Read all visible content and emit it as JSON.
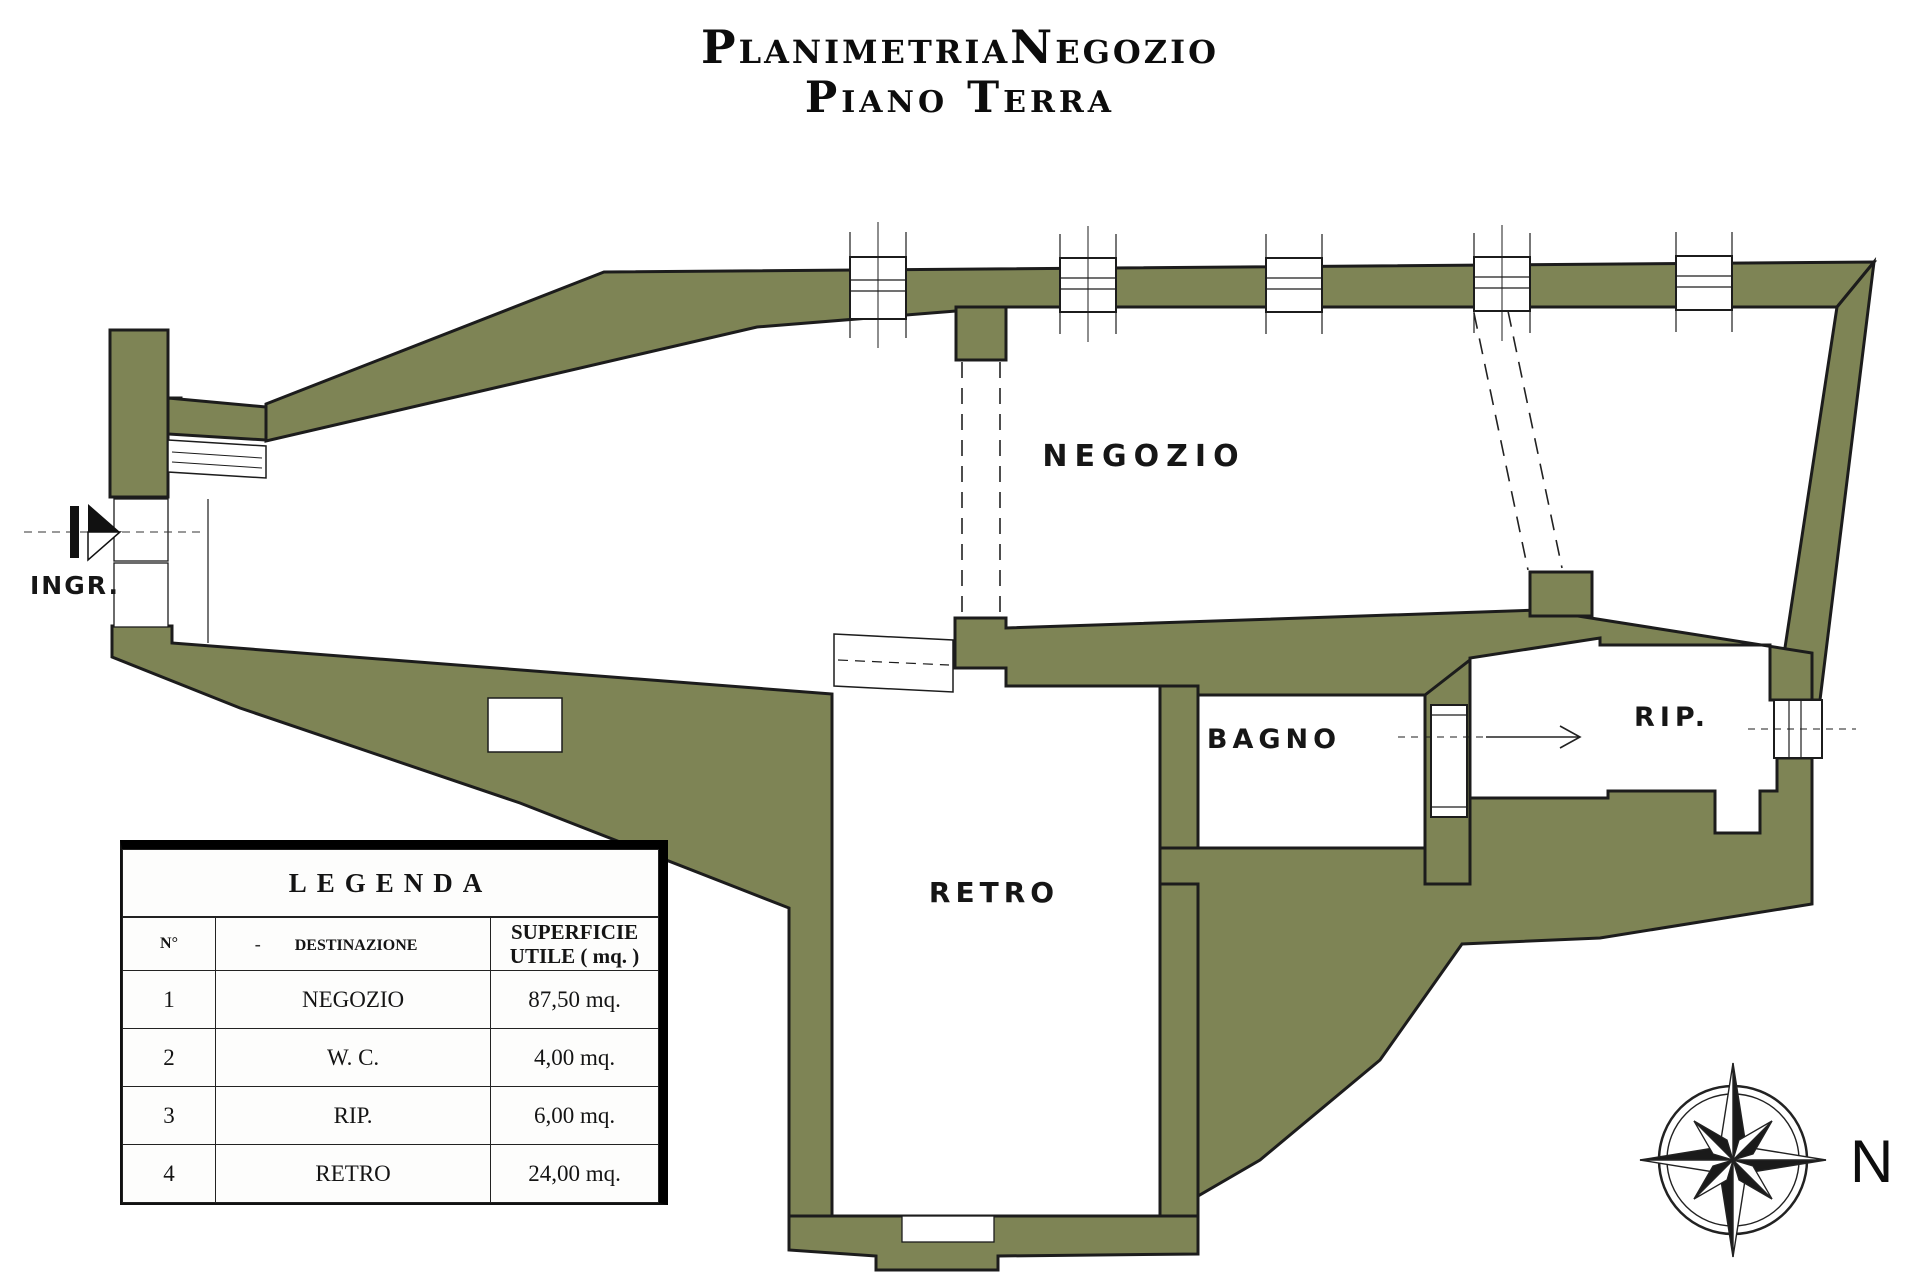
{
  "title": {
    "line1": "PlanimetriaNegozio",
    "line2": "Piano Terra"
  },
  "plan": {
    "colors": {
      "wall": "#7E8455",
      "outline": "#1C1C1C"
    },
    "labels": {
      "negozio": "NEGOZIO",
      "bagno": "BAGNO",
      "rip": "RIP.",
      "retro": "RETRO",
      "ingresso": "INGR."
    }
  },
  "legend": {
    "title": "LEGENDA",
    "header_dash": "-",
    "columns": {
      "n": "N°",
      "dest": "DESTINAZIONE",
      "sup": "SUPERFICIE UTILE ( mq. )"
    },
    "rows": [
      {
        "n": "1",
        "dest": "NEGOZIO",
        "sup": "87,50 mq."
      },
      {
        "n": "2",
        "dest": "W. C.",
        "sup": "4,00 mq."
      },
      {
        "n": "3",
        "dest": "RIP.",
        "sup": "6,00 mq."
      },
      {
        "n": "4",
        "dest": "RETRO",
        "sup": "24,00 mq."
      }
    ]
  },
  "compass": {
    "north_label": "N"
  }
}
